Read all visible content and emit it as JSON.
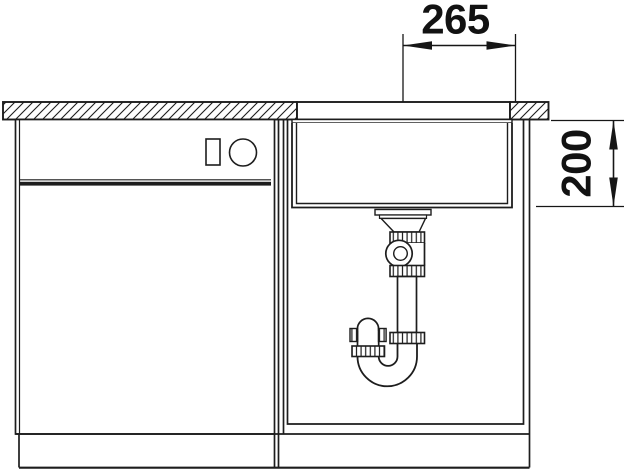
{
  "drawing": {
    "top_dimension_label": "265",
    "side_dimension_label": "200"
  },
  "style": {
    "line_color": "#1d1d1d",
    "dimension_text_color": "#121212",
    "background_color": "#ffffff"
  }
}
